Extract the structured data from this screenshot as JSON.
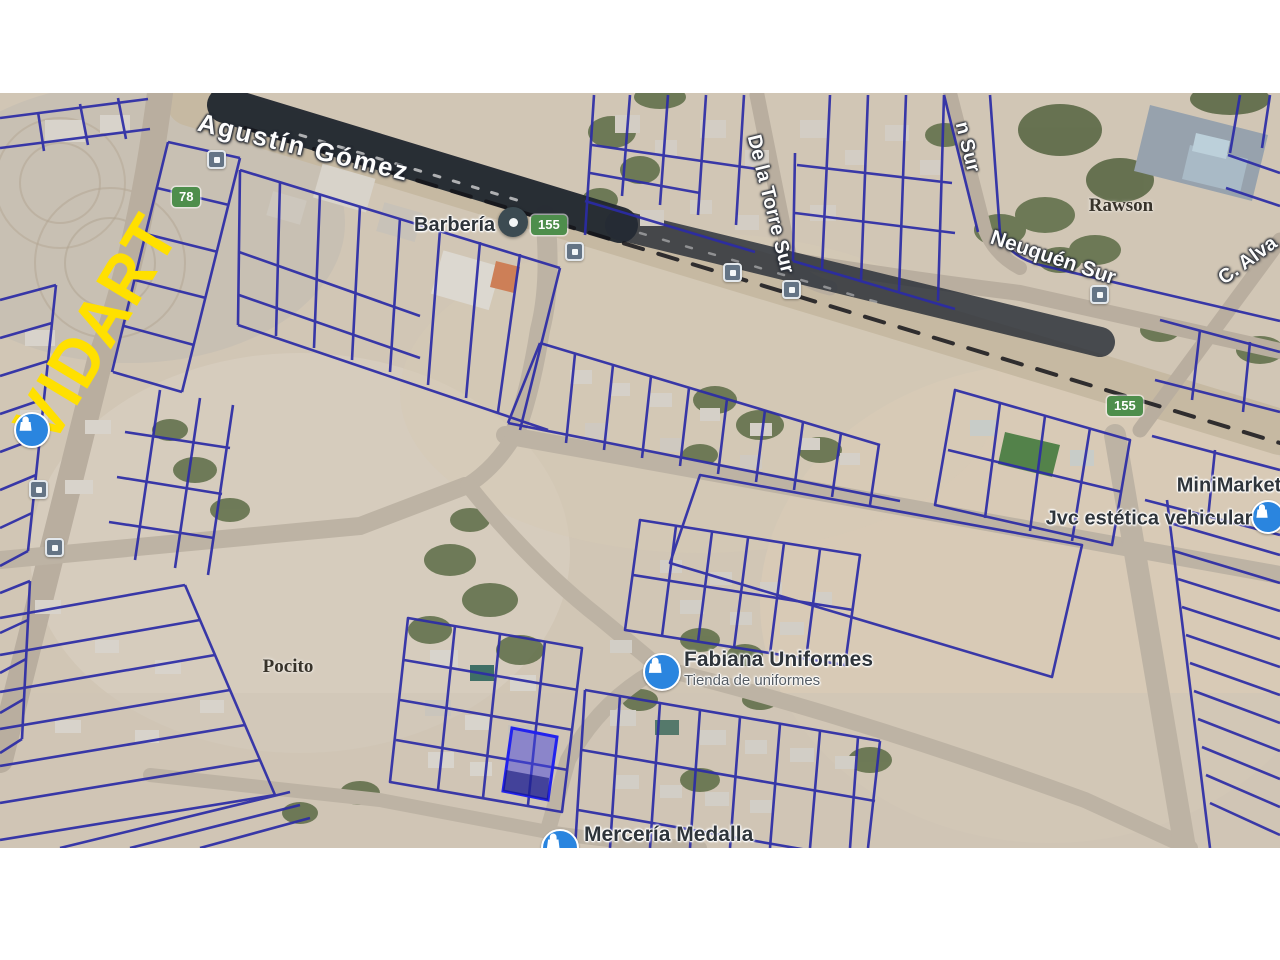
{
  "map": {
    "street_labels": {
      "agustin_gomez": "Agustín Gómez",
      "de_la_torre_sur": "De la Torre Sur",
      "n_sur": "n Sur",
      "neuquen_sur": "Neuquén Sur",
      "c_alvarez": "C. Alva",
      "vidart": "VIDART"
    },
    "locality_labels": {
      "rawson": "Rawson",
      "pocito": "Pocito"
    },
    "route_shields": [
      "78",
      "155",
      "155"
    ],
    "pois": {
      "barberia": {
        "name": "Barbería"
      },
      "fabiana": {
        "name": "Fabiana Uniformes",
        "category": "Tienda de uniformes"
      },
      "merceria": {
        "name": "Mercería Medalla"
      },
      "minimarket": {
        "name": "MiniMarket"
      },
      "jvc": {
        "name": "Jvc estética vehicular"
      }
    },
    "icons": {
      "poi_pin": "map-pin",
      "transit": "bus-stop",
      "shop": "shopping-bag"
    },
    "colors": {
      "parcel_line": "#2b2ba6",
      "highlight_fill": "#4646e0",
      "highlight_stroke": "#2222ee",
      "shield_green": "#4e8e4c",
      "poi_blue": "#2a85df",
      "vidart_yellow": "#ffe000",
      "railway_band": "#20262e",
      "terrain": "#d1c6b5"
    }
  }
}
